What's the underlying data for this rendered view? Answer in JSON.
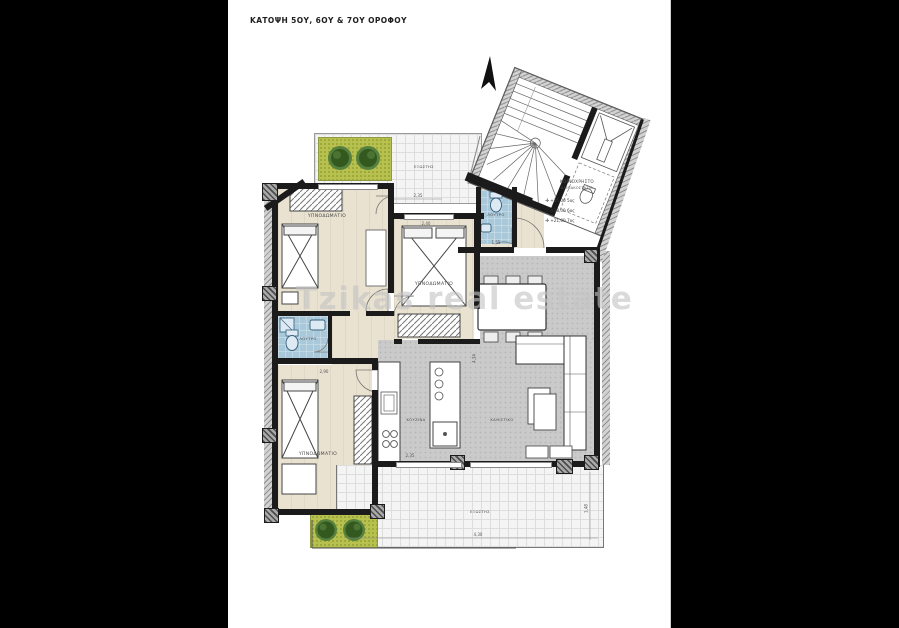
{
  "title": "ΚΑΤΟΨΗ 5ΟΥ, 6ΟΥ & 7ΟΥ ΟΡΟΦΟΥ",
  "watermark": "Tzikas real estate",
  "colors": {
    "backdrop": "#000000",
    "paper": "#ffffff",
    "wall": "#1b1b1b",
    "floor_bedroom": "#e9e2d0",
    "floor_open_plan": "#cacaca",
    "floor_bath": "#a9c8da",
    "balcony_tile": "#f4f4f4",
    "planter_grass": "#b9c14e",
    "tree_green": "#3f6d2c",
    "watermark_gray": "#c4c4c4"
  },
  "rooms": {
    "bedroom_top_left": {
      "label": "ΥΠΝΟΔΩΜΑΤΙΟ"
    },
    "bedroom_center": {
      "label": "ΥΠΝΟΔΩΜΑΤΙΟ"
    },
    "bedroom_bottom_left": {
      "label": "ΥΠΝΟΔΩΜΑΤΙΟ"
    },
    "bathroom": {
      "label": "ΛΟΥΤΡΟ"
    },
    "wc": {
      "label": "ΛΟΥΤΡΟ"
    },
    "kitchen": {
      "label": "ΚΟΥΖΙΝΑ"
    },
    "living": {
      "label": "ΚΑΘΙΣΤΙΚΟ"
    },
    "balcony_top": {
      "label": "ΕΞΩΣΤΗΣ"
    },
    "terrace": {
      "label": "ΕΞΩΣΤΗΣ"
    },
    "common_area": {
      "label": "ΚΟΙΝΟΧΡΗΣΤΟ",
      "sublabel": "ΚΛΙΜΑΚΟΣΤΑΣΙΟ"
    }
  },
  "levels": [
    {
      "mark": "+15,00",
      "floor": "5ος"
    },
    {
      "mark": "+18,00",
      "floor": "6ος"
    },
    {
      "mark": "+21,00",
      "floor": "7ος"
    }
  ],
  "dimensions": {
    "balcony_top_width": "2,35",
    "bedroom_center_top": "2,40",
    "wc_bottom": "1,55",
    "bedroom_bottom_top": "2,90",
    "kitchen_bottom": "2,35",
    "terrace_width": "4,30",
    "terrace_height": "1,48",
    "living_height": "4,34"
  }
}
